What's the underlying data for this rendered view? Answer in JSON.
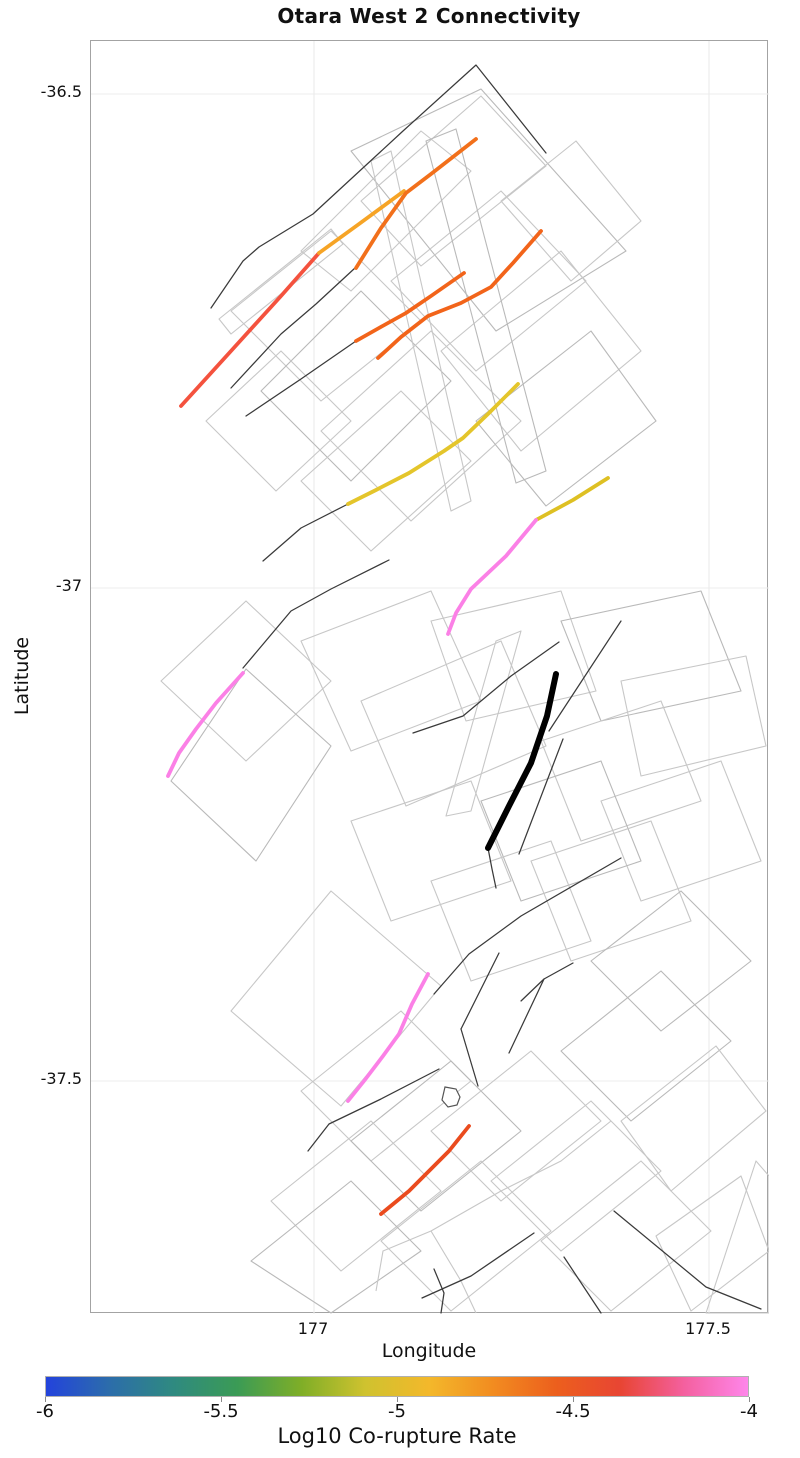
{
  "title": "Otara West 2 Connectivity",
  "axes": {
    "x_label": "Longitude",
    "y_label": "Latitude",
    "x_ticks": [
      {
        "label": "177",
        "px": 313
      },
      {
        "label": "177.5",
        "px": 708
      }
    ],
    "y_ticks": [
      {
        "label": "-36.5",
        "px": 93
      },
      {
        "label": "-37",
        "px": 587
      },
      {
        "label": "-37.5",
        "px": 1080
      }
    ]
  },
  "colorbar": {
    "label": "Log10 Co-rupture Rate",
    "min": -6,
    "max": -4,
    "ticks": [
      {
        "label": "-6",
        "frac": 0.0
      },
      {
        "label": "-5.5",
        "frac": 0.25
      },
      {
        "label": "-5",
        "frac": 0.5
      },
      {
        "label": "-4.5",
        "frac": 0.75
      },
      {
        "label": "-4",
        "frac": 1.0
      }
    ],
    "gradient": [
      "#2343dc",
      "#2c6daa",
      "#2f8a80",
      "#3b9b55",
      "#7fae27",
      "#cfc22f",
      "#f3b82b",
      "#f28c20",
      "#ec5f1d",
      "#e84533",
      "#f4609f",
      "#fe86ea"
    ]
  },
  "chart_data": {
    "type": "map",
    "title": "Otara West 2 Connectivity",
    "lon_range": [
      176.72,
      177.58
    ],
    "lat_range": [
      -37.74,
      -36.45
    ],
    "grid": true,
    "target_fault": {
      "name": "otara-west-2",
      "color": "#000000",
      "lonlat": [
        [
          177.31,
          -37.09
        ],
        [
          177.22,
          -37.26
        ]
      ],
      "points_px": [
        [
          555,
          673
        ],
        [
          546,
          715
        ],
        [
          530,
          762
        ],
        [
          508,
          805
        ],
        [
          487,
          847
        ]
      ]
    },
    "highlighted_segments": [
      {
        "name": "nw-red",
        "color": "#f4523e",
        "log10_rate": -4.35,
        "lonlat": [
          [
            176.83,
            -36.82
          ],
          [
            177.01,
            -36.66
          ]
        ],
        "points_px": [
          [
            180,
            405
          ],
          [
            230,
            350
          ],
          [
            280,
            295
          ],
          [
            318,
            252
          ]
        ]
      },
      {
        "name": "nw-yellow-orange",
        "color": "#f6a426",
        "log10_rate": -4.85,
        "lonlat": [
          [
            177.01,
            -36.66
          ],
          [
            177.11,
            -36.6
          ]
        ],
        "points_px": [
          [
            318,
            252
          ],
          [
            358,
            223
          ],
          [
            403,
            190
          ]
        ]
      },
      {
        "name": "north-orange-long",
        "color": "#f2701b",
        "log10_rate": -4.7,
        "lonlat": [
          [
            177.21,
            -36.55
          ],
          [
            177.05,
            -36.68
          ]
        ],
        "points_px": [
          [
            475,
            138
          ],
          [
            430,
            173
          ],
          [
            405,
            192
          ],
          [
            380,
            227
          ],
          [
            355,
            267
          ]
        ]
      },
      {
        "name": "north-orange-mid",
        "color": "#f2641a",
        "log10_rate": -4.7,
        "lonlat": [
          [
            177.19,
            -36.68
          ],
          [
            177.05,
            -36.75
          ]
        ],
        "points_px": [
          [
            463,
            272
          ],
          [
            430,
            295
          ],
          [
            405,
            312
          ],
          [
            378,
            327
          ],
          [
            355,
            340
          ]
        ]
      },
      {
        "name": "north-orange-low",
        "color": "#f2641a",
        "log10_rate": -4.75,
        "lonlat": [
          [
            177.29,
            -36.64
          ],
          [
            177.08,
            -36.77
          ]
        ],
        "points_px": [
          [
            540,
            230
          ],
          [
            512,
            262
          ],
          [
            490,
            286
          ],
          [
            460,
            302
          ],
          [
            427,
            315
          ],
          [
            400,
            336
          ],
          [
            377,
            357
          ]
        ]
      },
      {
        "name": "central-yellow-long",
        "color": "#e4c52b",
        "log10_rate": -5.0,
        "lonlat": [
          [
            177.26,
            -36.79
          ],
          [
            177.04,
            -36.92
          ]
        ],
        "points_px": [
          [
            517,
            383
          ],
          [
            488,
            412
          ],
          [
            462,
            437
          ],
          [
            443,
            450
          ],
          [
            408,
            472
          ],
          [
            375,
            489
          ],
          [
            347,
            503
          ]
        ]
      },
      {
        "name": "central-yellow-short",
        "color": "#dec023",
        "log10_rate": -5.05,
        "lonlat": [
          [
            177.37,
            -36.89
          ],
          [
            177.28,
            -36.93
          ]
        ],
        "points_px": [
          [
            607,
            477
          ],
          [
            572,
            499
          ],
          [
            535,
            519
          ]
        ]
      },
      {
        "name": "central-pink-east",
        "color": "#fb80e6",
        "log10_rate": -4.05,
        "lonlat": [
          [
            177.28,
            -36.93
          ],
          [
            177.17,
            -37.05
          ]
        ],
        "points_px": [
          [
            535,
            519
          ],
          [
            505,
            555
          ],
          [
            470,
            588
          ],
          [
            455,
            612
          ],
          [
            447,
            633
          ]
        ]
      },
      {
        "name": "central-pink-west",
        "color": "#fb80e6",
        "log10_rate": -4.05,
        "lonlat": [
          [
            176.91,
            -37.09
          ],
          [
            176.82,
            -37.19
          ]
        ],
        "points_px": [
          [
            242,
            672
          ],
          [
            215,
            702
          ],
          [
            195,
            728
          ],
          [
            178,
            752
          ],
          [
            167,
            775
          ]
        ]
      },
      {
        "name": "south-pink",
        "color": "#fb80e6",
        "log10_rate": -4.1,
        "lonlat": [
          [
            177.14,
            -37.39
          ],
          [
            177.04,
            -37.52
          ]
        ],
        "points_px": [
          [
            427,
            973
          ],
          [
            411,
            1003
          ],
          [
            398,
            1033
          ],
          [
            382,
            1055
          ],
          [
            363,
            1080
          ],
          [
            347,
            1100
          ]
        ]
      },
      {
        "name": "south-orange-red",
        "color": "#ea4b1e",
        "log10_rate": -4.55,
        "lonlat": [
          [
            177.2,
            -37.55
          ],
          [
            177.08,
            -37.64
          ]
        ],
        "points_px": [
          [
            468,
            1125
          ],
          [
            448,
            1150
          ],
          [
            430,
            1168
          ],
          [
            408,
            1190
          ],
          [
            380,
            1213
          ]
        ]
      }
    ],
    "map_geometry": {
      "view_box": "90 40 678 1273",
      "plot_px": {
        "left": 90,
        "top": 40,
        "right": 768,
        "bottom": 1313
      },
      "surface_polygons": [
        "350,150 480,88 625,250 495,330",
        "300,250 420,130 470,170 350,290",
        "360,200 480,95 545,165 420,265",
        "230,310 330,230 420,320 320,400",
        "260,390 360,290 450,380 350,480",
        "320,430 430,330 520,420 410,520",
        "390,280 500,190 585,280 475,370",
        "440,350 560,250 640,350 520,450",
        "475,420 590,330 655,420 545,505",
        "300,480 400,390 470,460 370,550",
        "205,420 280,350 350,420 275,490",
        "500,200 575,140 640,220 570,280",
        "425,140 455,128 545,470 515,482",
        "370,160 390,150 470,500 450,510",
        "218,318 330,228 342,243 230,333",
        "160,680 245,600 330,680 245,760",
        "170,780 245,668 330,745 255,860",
        "300,640 430,590 480,700 350,750",
        "360,700 500,640 545,745 405,805",
        "430,620 560,590 595,690 465,720",
        "560,620 700,590 740,690 600,720",
        "620,680 745,655 765,745 640,775",
        "540,740 660,700 700,800 580,840",
        "600,800 720,760 760,860 640,900",
        "480,800 600,760 640,860 520,900",
        "350,820 470,780 510,880 390,920",
        "530,860 650,820 690,920 570,960",
        "430,880 550,840 590,940 470,980",
        "590,960 680,890 750,960 660,1030",
        "230,1010 330,890 440,985 340,1105",
        "495,640 520,630 470,810 445,815",
        "300,1090 400,1010 470,1080 370,1160",
        "350,1140 450,1060 520,1130 420,1210",
        "270,1200 370,1120 440,1190 340,1270",
        "430,1130 530,1050 600,1120 500,1200",
        "490,1180 590,1100 660,1170 560,1250",
        "560,1050 660,970 730,1040 630,1120",
        "620,1120 715,1045 765,1110 670,1190",
        "540,1240 640,1160 710,1230 610,1310",
        "380,1240 480,1160 550,1230 450,1310",
        "250,1260 350,1180 420,1250 330,1312",
        "655,1235 740,1175 768,1250 690,1310",
        "705,1312 755,1160 768,1175 768,1312"
      ],
      "gray_lines": [
        "375,1290 382,1250 430,1230 500,1190 560,1160 610,1120",
        "430,1230 460,1280 475,1312"
      ],
      "fault_traces": [
        "210,307 242,260 258,246 312,213 402,130 475,64 545,152",
        "354,267 315,303 280,333 230,387",
        "355,340 300,378 245,415",
        "347,503 300,527 262,560",
        "388,559 330,588 290,610 242,667",
        "558,641 510,675 462,715 412,732",
        "620,620 548,730",
        "562,738 518,853",
        "620,857 520,915 468,953 433,993",
        "487,847 491,868 495,887",
        "498,952 460,1028",
        "460,1028 477,1085",
        "572,962 543,978 520,1000",
        "543,978 508,1052",
        "438,1068 380,1098 328,1123 307,1150",
        "613,1210 705,1286 760,1308",
        "533,1232 470,1275 421,1297",
        "563,1256 600,1312",
        "433,1268 443,1292 440,1312"
      ],
      "islet_path": "M444,1086 L455,1088 L459,1096 L456,1104 L447,1106 L441,1099 Z"
    }
  }
}
